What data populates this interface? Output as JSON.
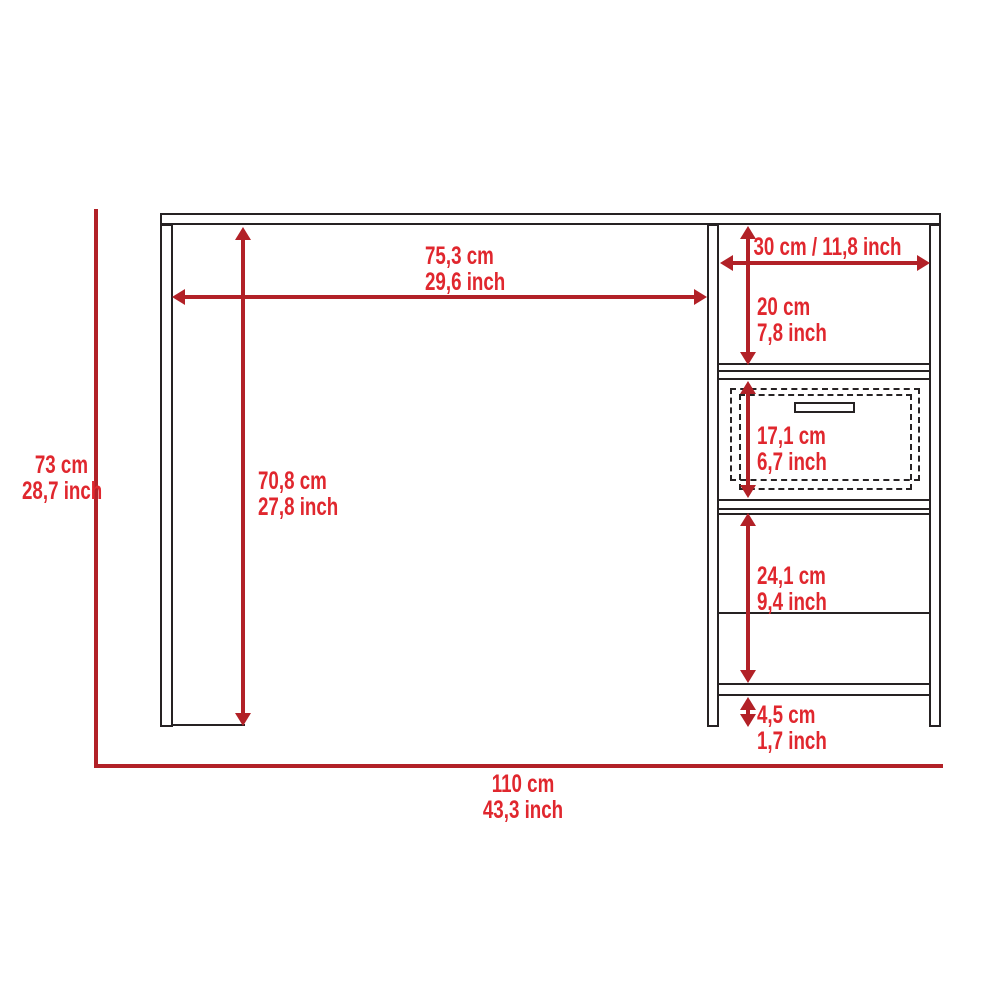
{
  "diagram": {
    "kind": "furniture dimension drawing",
    "subject": "desk with side storage unit, front elevation",
    "colors": {
      "dimension_line": "#b22127",
      "dimension_text": "#e0272e",
      "outline": "#262223",
      "background": "#ffffff"
    }
  },
  "labels": {
    "overall_width_cm": "110 cm",
    "overall_width_in": "43,3 inch",
    "overall_height_cm": "73 cm",
    "overall_height_in": "28,7 inch",
    "worktop_clearance_cm": "75,3 cm",
    "worktop_clearance_in": "29,6 inch",
    "leg_clearance_cm": "70,8 cm",
    "leg_clearance_in": "27,8 inch",
    "side_unit_width": "30 cm / 11,8 inch",
    "upper_cubby_cm": "20 cm",
    "upper_cubby_in": "7,8 inch",
    "drawer_cm": "17,1 cm",
    "drawer_in": "6,7 inch",
    "lower_cubby_cm": "24,1 cm",
    "lower_cubby_in": "9,4 inch",
    "leg_height_cm": "4,5 cm",
    "leg_height_in": "1,7 inch"
  }
}
